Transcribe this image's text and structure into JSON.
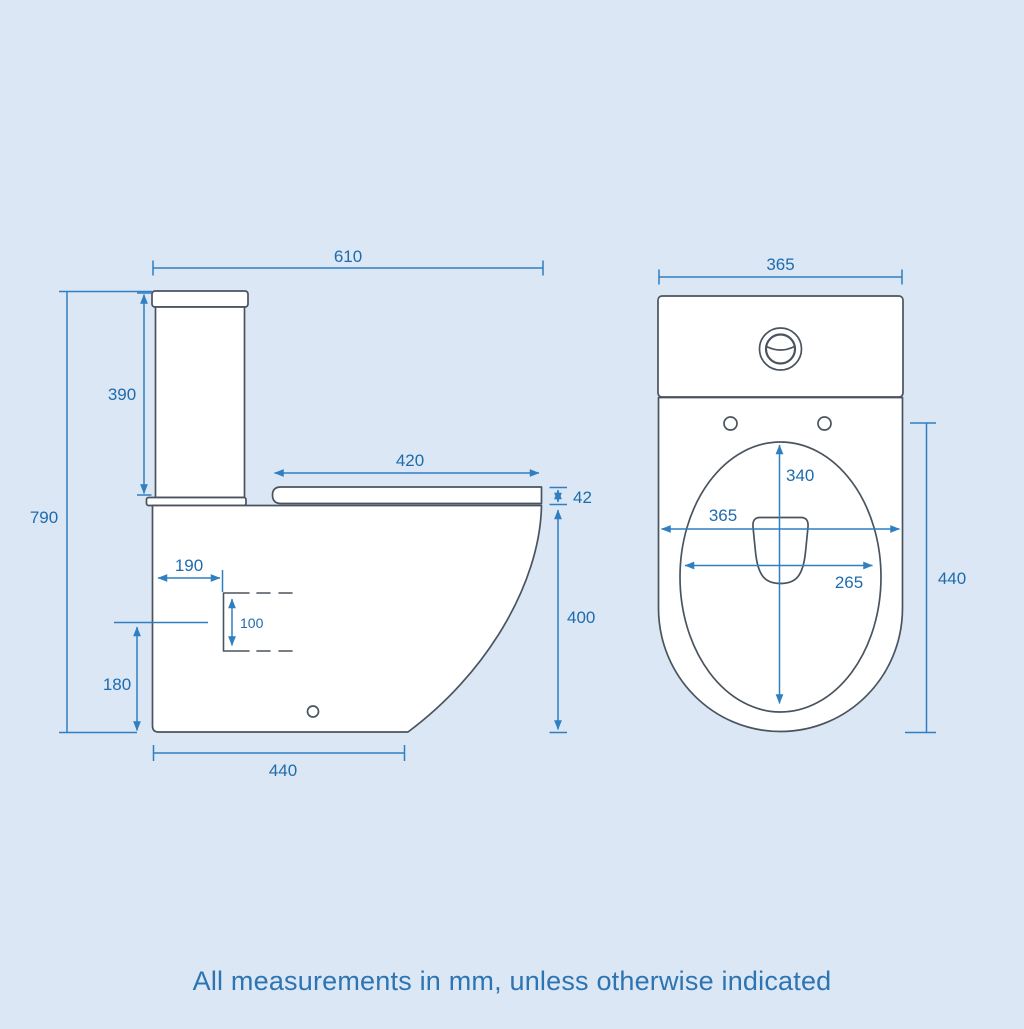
{
  "footnote": "All measurements in mm, unless otherwise indicated",
  "colors": {
    "background": "#dbe7f4",
    "outline": "#4a545e",
    "dimension_line": "#2f7fc1",
    "dimension_text": "#1e6cad"
  },
  "side": {
    "dims": {
      "total_width": "610",
      "cistern_height": "390",
      "total_height": "790",
      "seat_depth": "420",
      "seat_thickness": "42",
      "outlet_setback": "190",
      "outlet_size": "100",
      "outlet_height": "180",
      "rim_height": "400",
      "base_depth": "440"
    }
  },
  "front": {
    "dims": {
      "overall_width": "365",
      "bowl_length": "340",
      "rim_width": "365",
      "bowl_width": "265",
      "pan_depth": "440"
    }
  }
}
